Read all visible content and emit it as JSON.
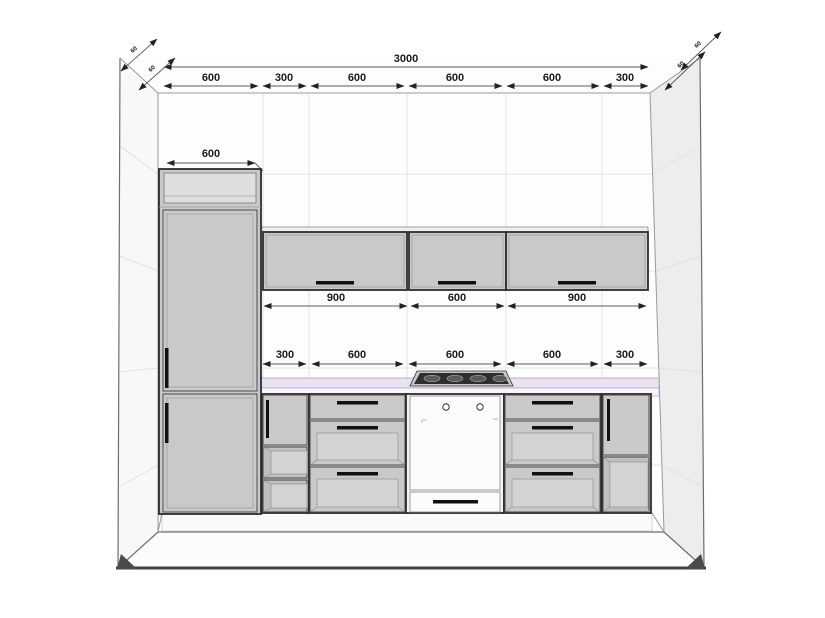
{
  "dimensions": {
    "total": "3000",
    "top_row": [
      "600",
      "300",
      "600",
      "600",
      "600",
      "300"
    ],
    "tall_width": "600",
    "wall_row": [
      "900",
      "600",
      "900"
    ],
    "base_row": [
      "300",
      "600",
      "600",
      "600",
      "300"
    ],
    "corner_left": [
      "60",
      "60"
    ],
    "corner_right": [
      "60",
      "60"
    ]
  },
  "colors": {
    "cab": "#c9c9c9",
    "cab_stroke": "#2d2d2d",
    "handle": "#111111",
    "counter": "#eae2f0",
    "wall": "#fdfdfd",
    "tile": "#e2e2e2",
    "side_wall": "#ededed",
    "floor_edge": "#3f3f3f",
    "dim": "#1a1a1a"
  }
}
